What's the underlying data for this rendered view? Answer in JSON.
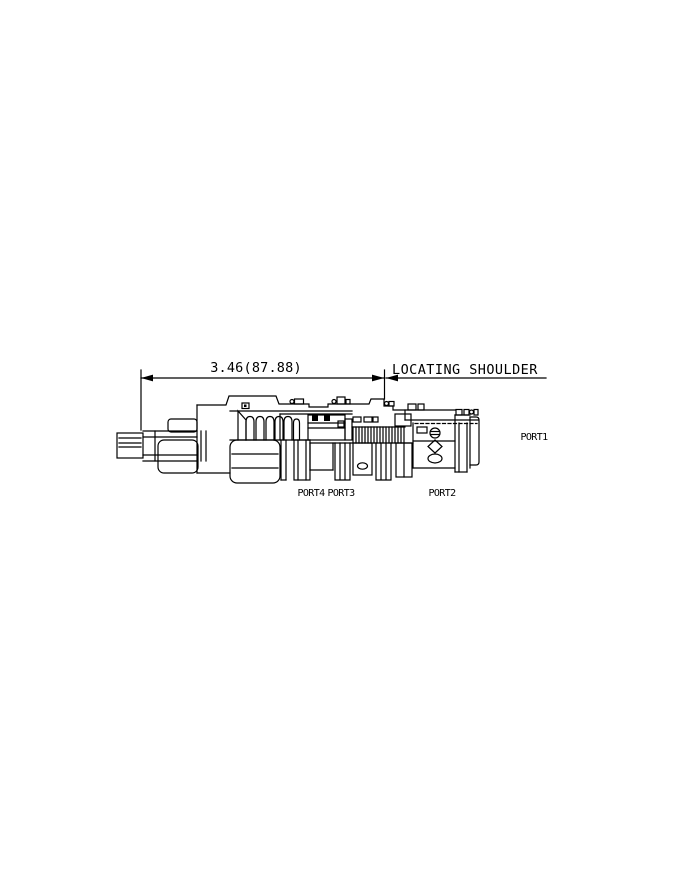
{
  "page": {
    "background": "#ffffff"
  },
  "drawing": {
    "type": "hydraulic-cartridge-valve-section",
    "line_color": "#000000",
    "dimension": {
      "label": "3.46(87.88)"
    },
    "locating_shoulder": {
      "label": "LOCATING SHOULDER"
    },
    "ports": {
      "port1": "PORT1",
      "port2": "PORT2",
      "port3": "PORT3",
      "port4": "PORT4"
    }
  }
}
